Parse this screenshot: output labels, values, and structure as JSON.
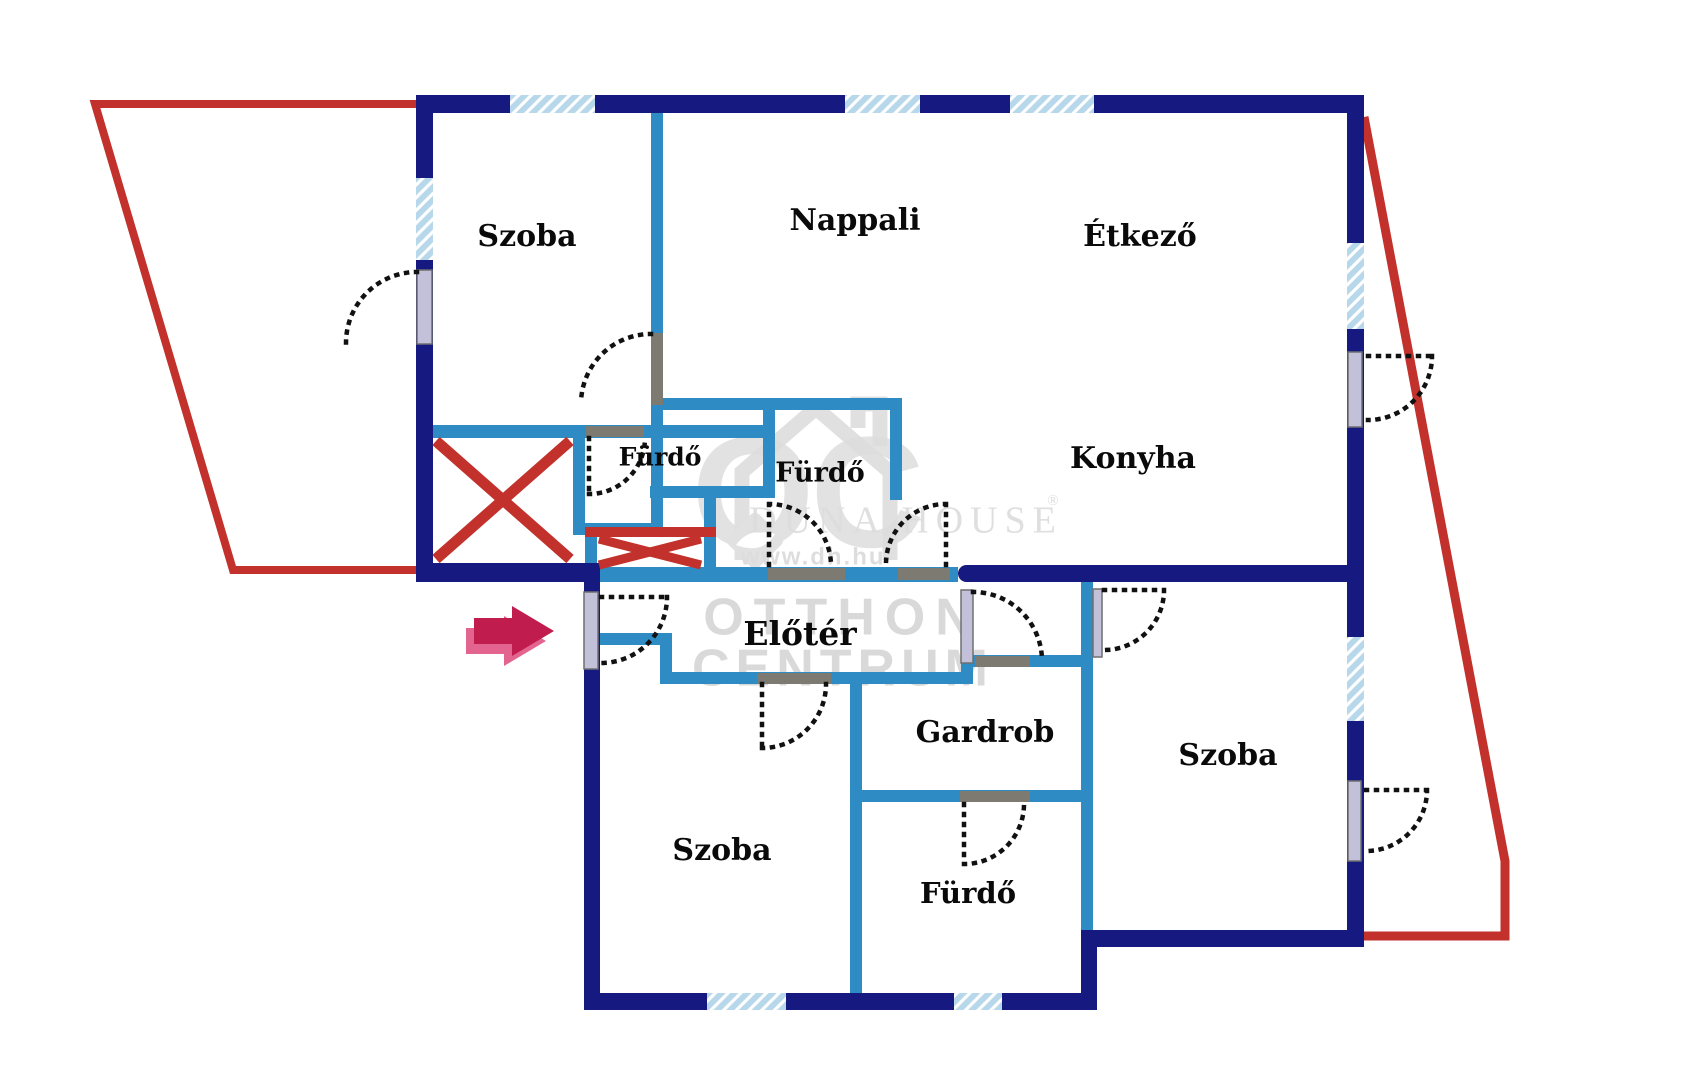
{
  "plan": {
    "type": "apartment-floor-plan",
    "rooms": [
      {
        "id": "szoba-top-left",
        "label": "Szoba"
      },
      {
        "id": "nappali",
        "label": "Nappali"
      },
      {
        "id": "etkezo",
        "label": "Étkező"
      },
      {
        "id": "konyha",
        "label": "Konyha"
      },
      {
        "id": "furdo-1",
        "label": "Fürdő"
      },
      {
        "id": "furdo-2",
        "label": "Fürdő"
      },
      {
        "id": "eloter",
        "label": "Előtér"
      },
      {
        "id": "gardrob",
        "label": "Gardrob"
      },
      {
        "id": "szoba-bottom-left",
        "label": "Szoba"
      },
      {
        "id": "furdo-3",
        "label": "Fürdő"
      },
      {
        "id": "szoba-right",
        "label": "Szoba"
      }
    ],
    "watermark": {
      "monogram": "OC",
      "brand": "DUNA HOUSE",
      "registered": "®",
      "website": "www.dh.hu",
      "line1": "OTTHON",
      "line2": "CENTRUM"
    },
    "colors": {
      "outer_wall": "#151980",
      "inner_wall": "#2e8bc4",
      "terrace_line": "#c2312b",
      "window_fill": "#b7d7ea",
      "arrow_dark": "#c01d4e",
      "arrow_light": "#e2648f",
      "door_panel": "#c3c1da",
      "door_lintel": "#7d7a72",
      "watermark_gray": "#c6c6c6"
    }
  }
}
